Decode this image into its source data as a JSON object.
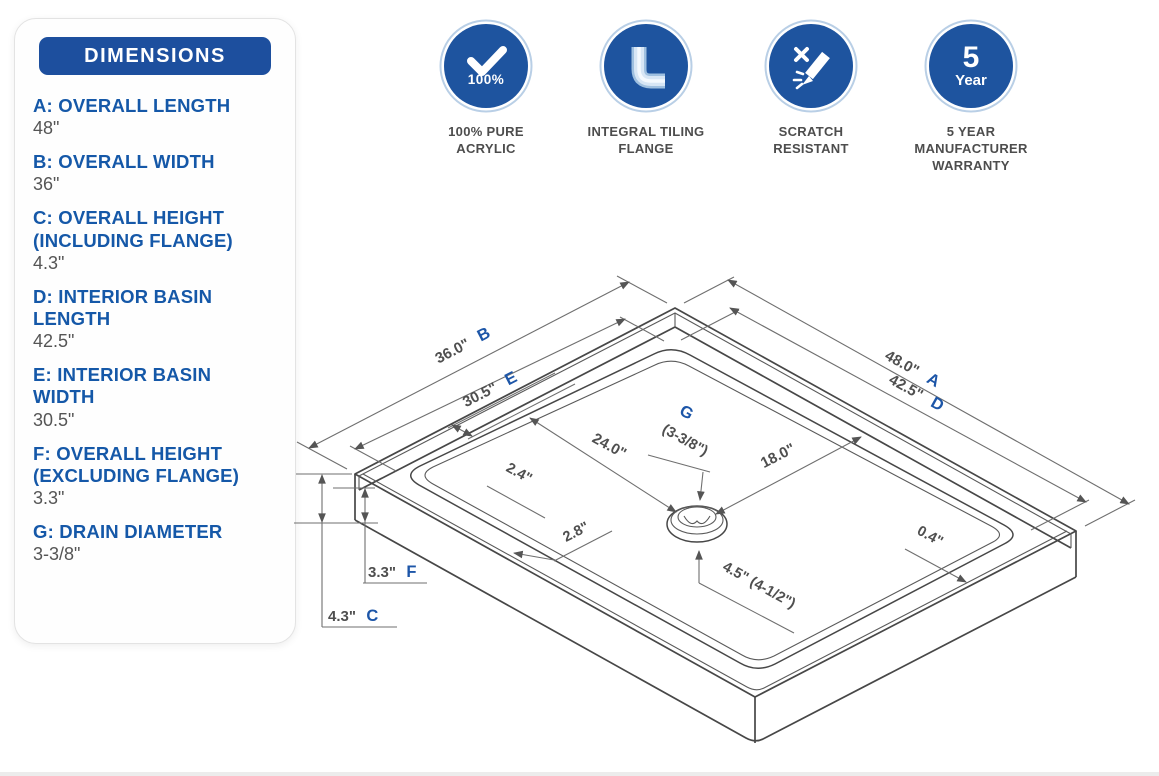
{
  "panel": {
    "title": "DIMENSIONS",
    "items": [
      {
        "label": "A: OVERALL LENGTH",
        "value": "48\""
      },
      {
        "label": "B: OVERALL WIDTH",
        "value": "36\""
      },
      {
        "label": "C: OVERALL HEIGHT (INCLUDING FLANGE)",
        "value": "4.3\""
      },
      {
        "label": "D: INTERIOR BASIN LENGTH",
        "value": "42.5\""
      },
      {
        "label": "E: INTERIOR BASIN WIDTH",
        "value": "30.5\""
      },
      {
        "label": "F: OVERALL HEIGHT (EXCLUDING FLANGE)",
        "value": "3.3\""
      },
      {
        "label": "G: DRAIN DIAMETER",
        "value": "3-3/8\""
      }
    ]
  },
  "badges": [
    {
      "icon": "check-100-icon",
      "icon_text": "100%",
      "label": "100% PURE ACRYLIC"
    },
    {
      "icon": "tiling-flange-icon",
      "label": "INTEGRAL TILING FLANGE"
    },
    {
      "icon": "scratch-resistant-icon",
      "label": "SCRATCH RESISTANT"
    },
    {
      "icon": "five-year-icon",
      "icon_text_top": "5",
      "icon_text_bottom": "Year",
      "label": "5 YEAR MANUFACTURER WARRANTY"
    }
  ],
  "drawing": {
    "dims": {
      "overall_width": {
        "value": "36.0\"",
        "letter": "B"
      },
      "interior_width": {
        "value": "30.5\"",
        "letter": "E"
      },
      "overall_length": {
        "value": "48.0\"",
        "letter": "A"
      },
      "interior_length": {
        "value": "42.5\"",
        "letter": "D"
      },
      "drain_from_left": "24.0\"",
      "drain_from_back": "18.0\"",
      "deck_back_strip": "2.4\"",
      "deck_front_strip": "2.8\"",
      "rim_width": "0.4\"",
      "drain_assembly": "4.5\" (4-1/2\")",
      "drain_letter": "G",
      "drain_size": "(3-3/8\")",
      "height_excluding": {
        "value": "3.3\"",
        "letter": "F"
      },
      "height_including": {
        "value": "4.3\"",
        "letter": "C"
      }
    }
  },
  "colors": {
    "brand_blue": "#1d4f9e",
    "badge_blue": "#1e549f",
    "accent_text_blue": "#1d56a8",
    "drawing_line": "#474747",
    "value_gray": "#4f4f4f"
  }
}
